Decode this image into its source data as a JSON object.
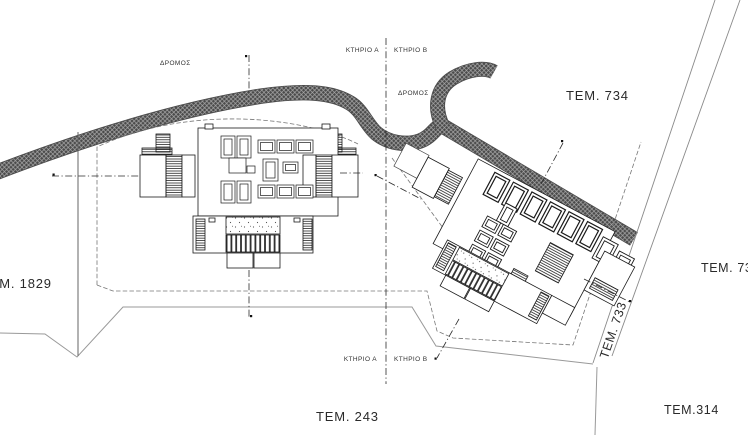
{
  "labels": {
    "road_upper": "ΔΡΟΜΟΣ",
    "road_lower": "ΔΡΟΜΟΣ",
    "building_a_top": "ΚΤΗΡΙΟ Α",
    "building_b_top": "ΚΤΗΡΙΟ Β",
    "building_a_bottom": "ΚΤΗΡΙΟ Α",
    "building_b_bottom": "ΚΤΗΡΙΟ Β",
    "parcel_734": "ΤΕΜ. 734",
    "parcel_733": "ΤΕΜ. 733",
    "parcel_732_clipped": "ΤΕΜ. 732",
    "parcel_1829": "ΤΕΜ. 1829",
    "parcel_243": "ΤΕΜ. 243",
    "parcel_314": "ΤΕΜ.314"
  },
  "colors": {
    "ink": "#1a1a1a",
    "road_outline": "#4a4a4a",
    "road_hatch": "#adadad",
    "boundary_double_line": "#8a8a8a",
    "boundary_dashed": "#777777",
    "boundary_solid_gray": "#999999"
  }
}
